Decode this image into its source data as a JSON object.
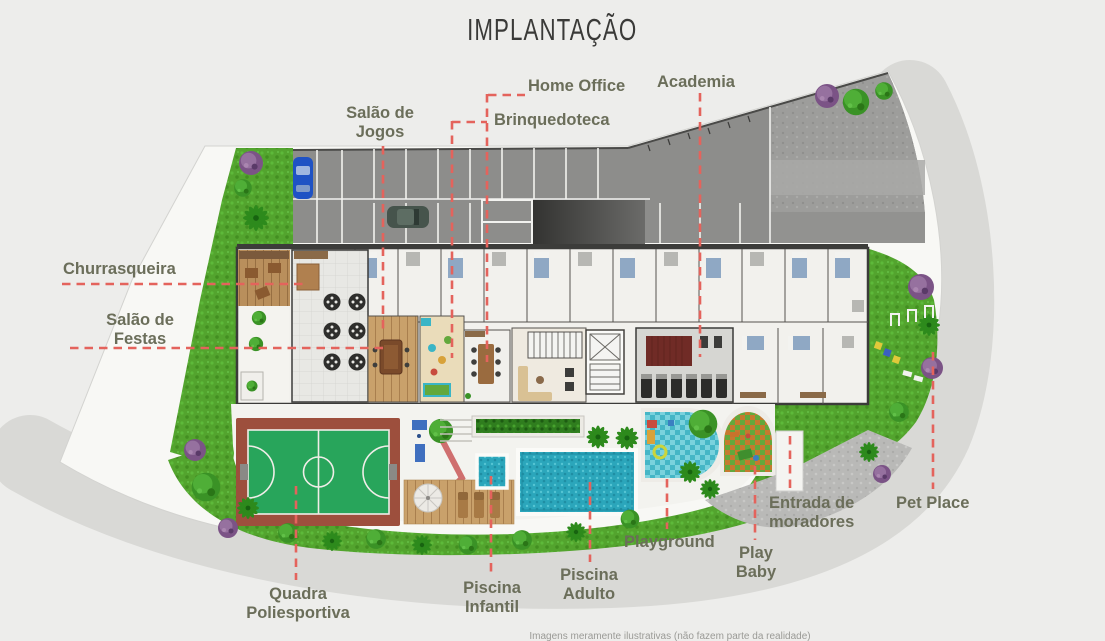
{
  "title": "IMPLANTAÇÃO",
  "disclaimer": "Imagens meramente ilustrativas (não fazem parte da realidade)",
  "labels": {
    "home_office": "Home Office",
    "academia": "Academia",
    "salao_jogos": [
      "Salão de",
      "Jogos"
    ],
    "brinquedoteca": "Brinquedoteca",
    "churrasqueira": "Churrasqueira",
    "salao_festas": [
      "Salão de",
      "Festas"
    ],
    "quadra": [
      "Quadra",
      "Poliesportiva"
    ],
    "piscina_infantil": [
      "Piscina",
      "Infantil"
    ],
    "piscina_adulto": [
      "Piscina",
      "Adulto"
    ],
    "playground": "Playground",
    "play_baby": [
      "Play",
      "Baby"
    ],
    "entrada": [
      "Entrada de",
      "moradores"
    ],
    "pet_place": "Pet Place"
  },
  "colors": {
    "leader_line": "#e4635c",
    "label_text": "#6b6e5a",
    "grass": "#53a42e",
    "pool_water": "#2ba6bb",
    "court_green": "#28a55b",
    "court_clay": "#9d4f3d",
    "parking_asphalt": "#8d8d8b",
    "wood_deck": "#c9a16b",
    "site_platform": "#f8f8f5",
    "road_band": "#d9d9d6"
  }
}
